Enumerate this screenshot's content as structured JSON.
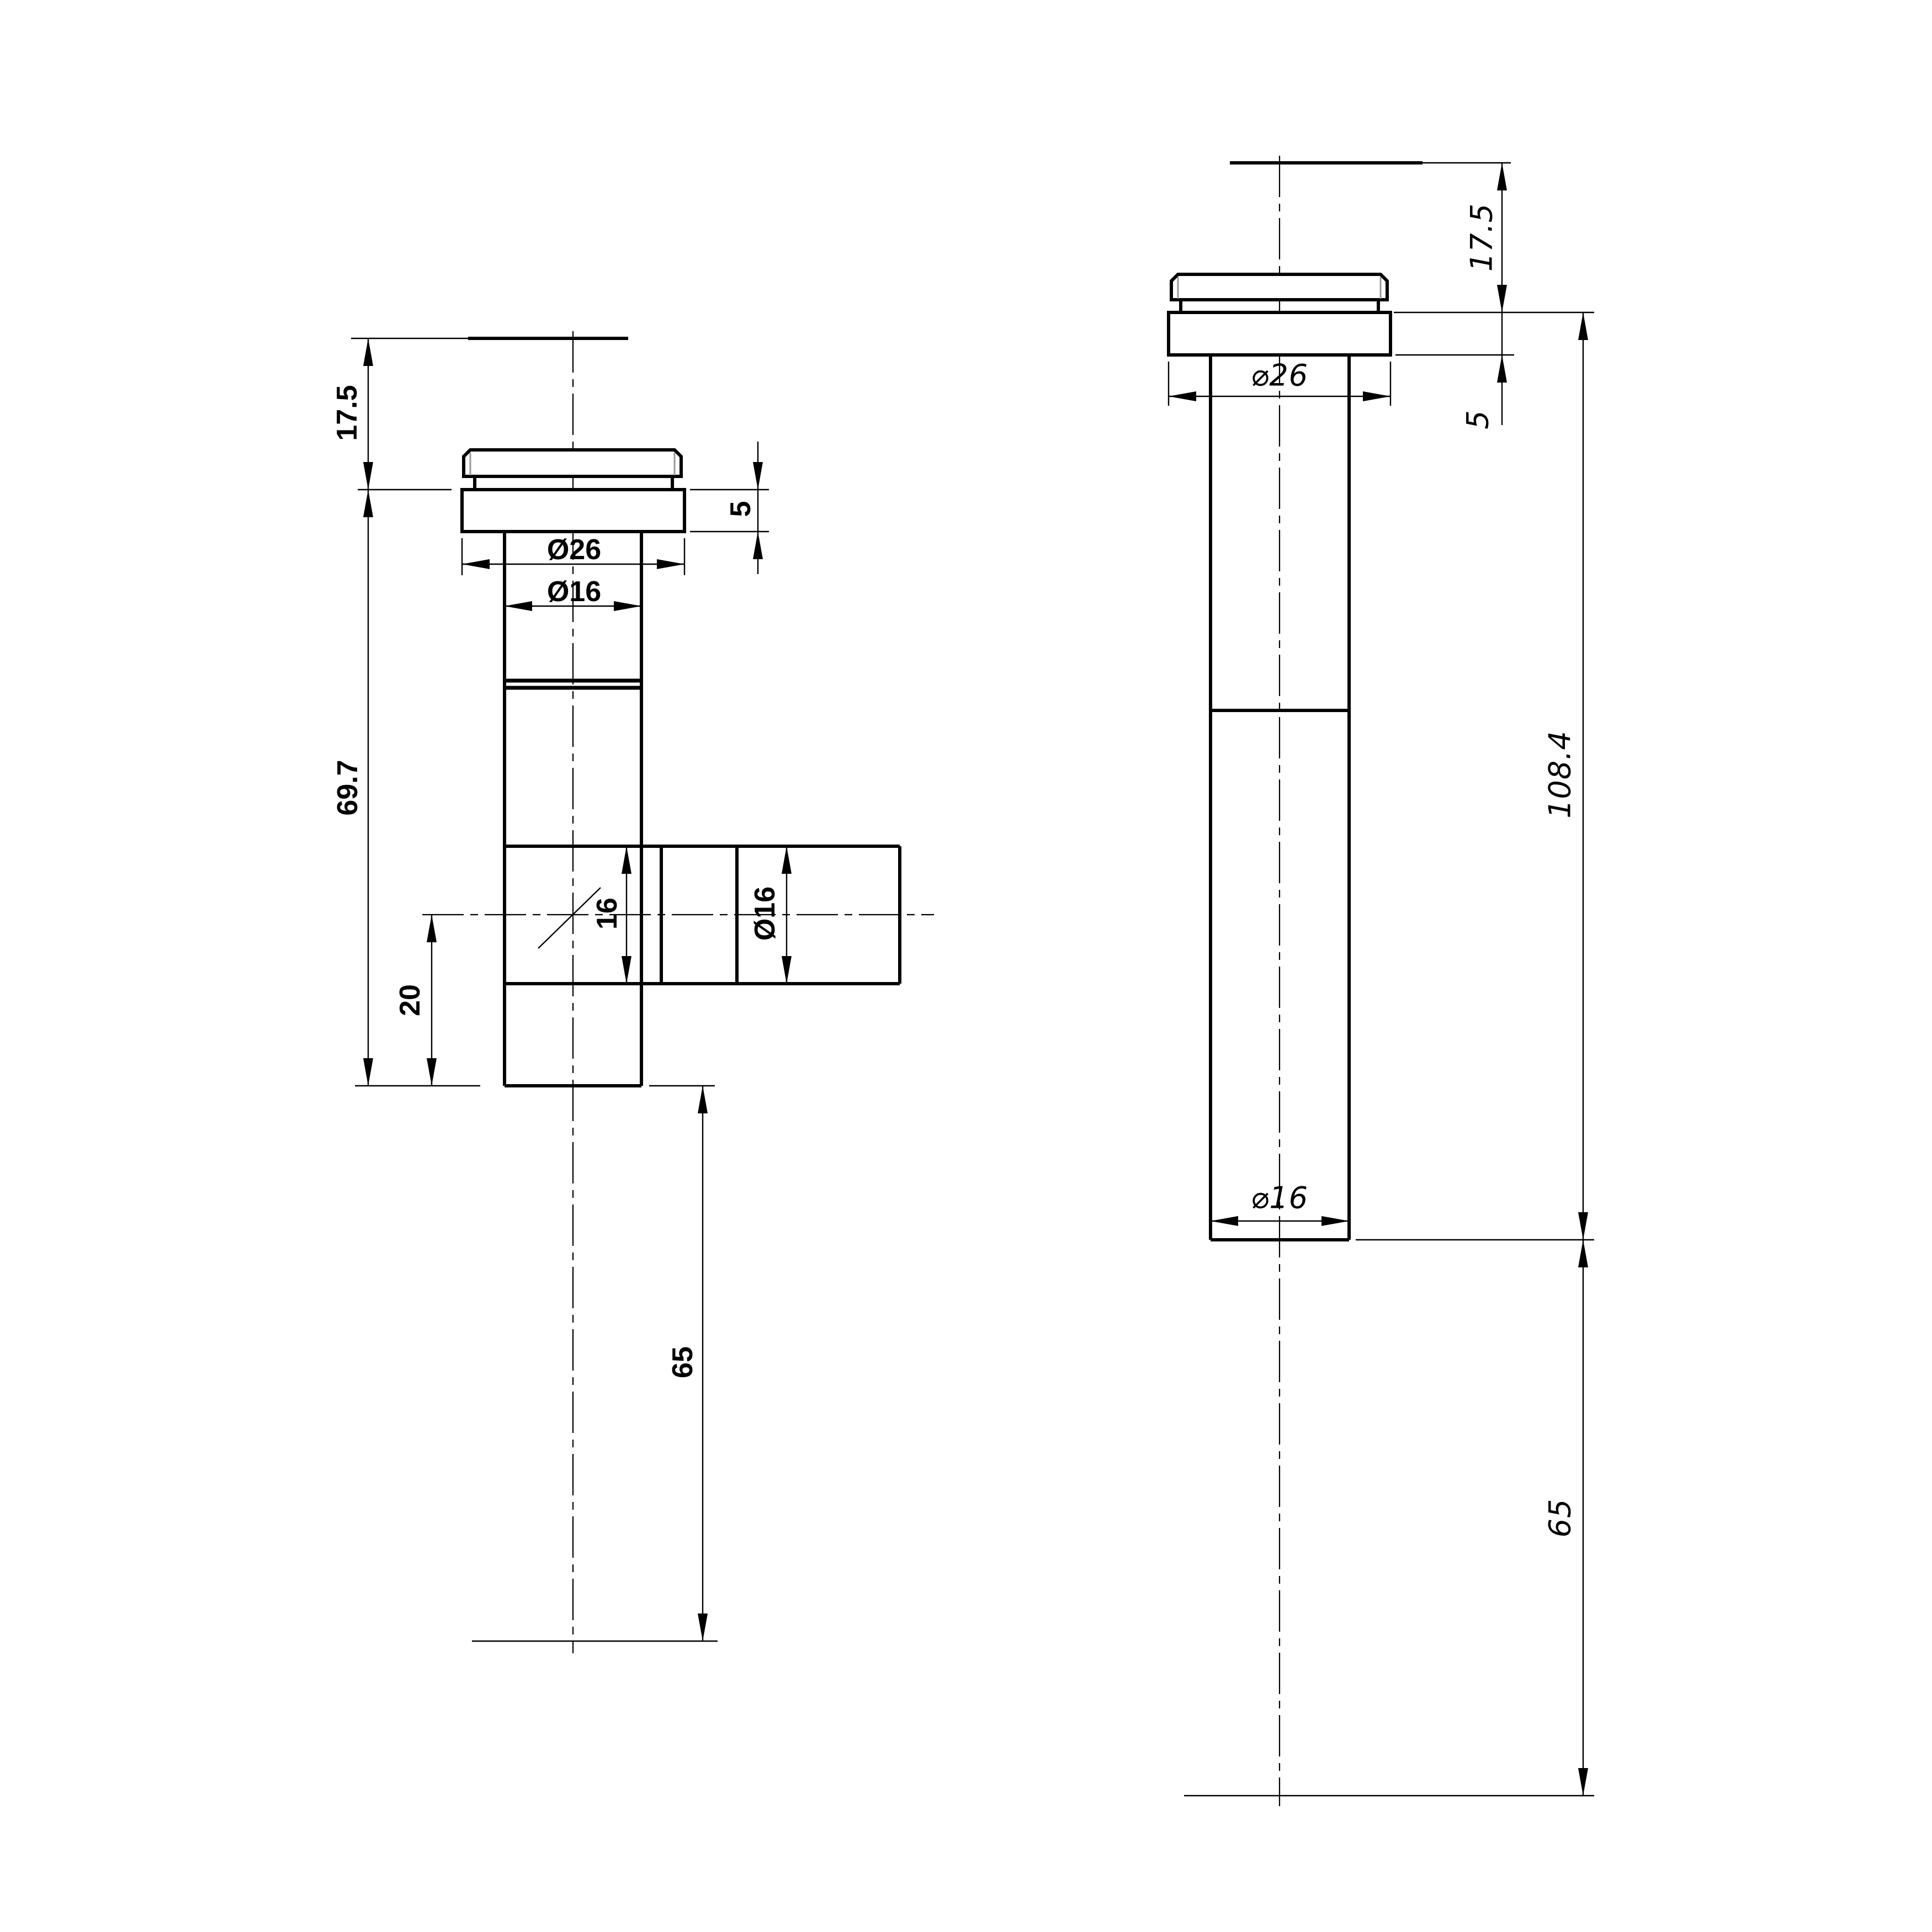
{
  "drawing": {
    "type": "technical-drawing",
    "background": "#ffffff",
    "line_color": "#000000",
    "views": {
      "left": {
        "name": "valve body with side branch - front view",
        "dims": {
          "cap_height": "17.5",
          "body_length": "69.7",
          "branch_offset": "20",
          "flange_thickness": "5",
          "flange_diameter": "Ø26",
          "tube_diameter": "Ø16",
          "branch_bore": "16",
          "branch_diameter": "Ø16",
          "stem_length": "65"
        }
      },
      "right": {
        "name": "straight valve body - side view",
        "dims": {
          "cap_height": "17.5",
          "flange_thickness": "5",
          "flange_diameter": "⌀26",
          "total_length": "108.4",
          "tube_diameter": "⌀16",
          "stem_length": "65"
        }
      }
    }
  }
}
